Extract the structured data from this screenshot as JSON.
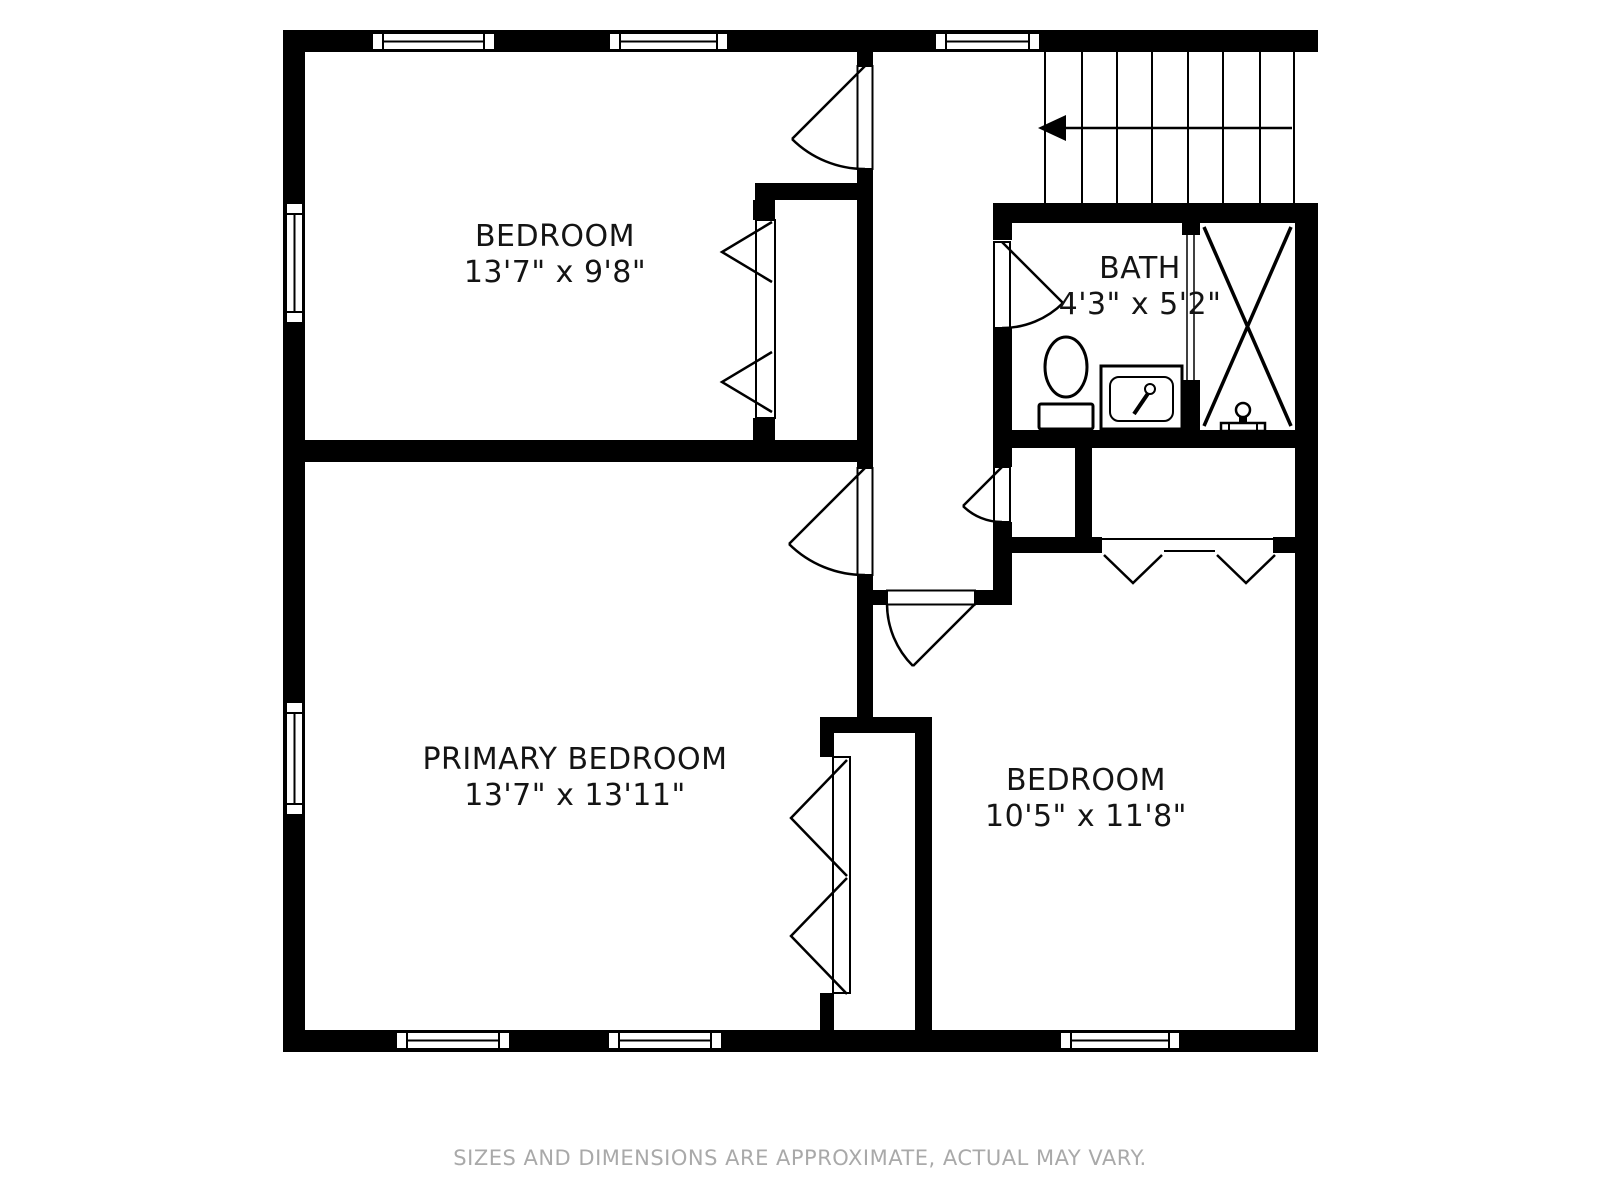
{
  "floor_plan": {
    "rooms": [
      {
        "id": "bedroom-top",
        "name": "BEDROOM",
        "dimensions": "13'7\" x 9'8\""
      },
      {
        "id": "primary-bedroom",
        "name": "PRIMARY BEDROOM",
        "dimensions": "13'7\" x 13'11\""
      },
      {
        "id": "bath",
        "name": "BATH",
        "dimensions": "4'3\" x 5'2\""
      },
      {
        "id": "bedroom-right",
        "name": "BEDROOM",
        "dimensions": "10'5\" x 11'8\""
      }
    ],
    "fixtures": [
      "toilet",
      "sink",
      "shower"
    ],
    "features": [
      "stairs-with-down-arrow",
      "windows",
      "swing-doors",
      "bifold-closet-doors"
    ],
    "footer_note": "SIZES AND DIMENSIONS ARE APPROXIMATE, ACTUAL MAY VARY.",
    "colors": {
      "walls": "#000000",
      "background": "#ffffff",
      "label_text": "#141414",
      "footer_text": "#a9a9a9"
    }
  }
}
